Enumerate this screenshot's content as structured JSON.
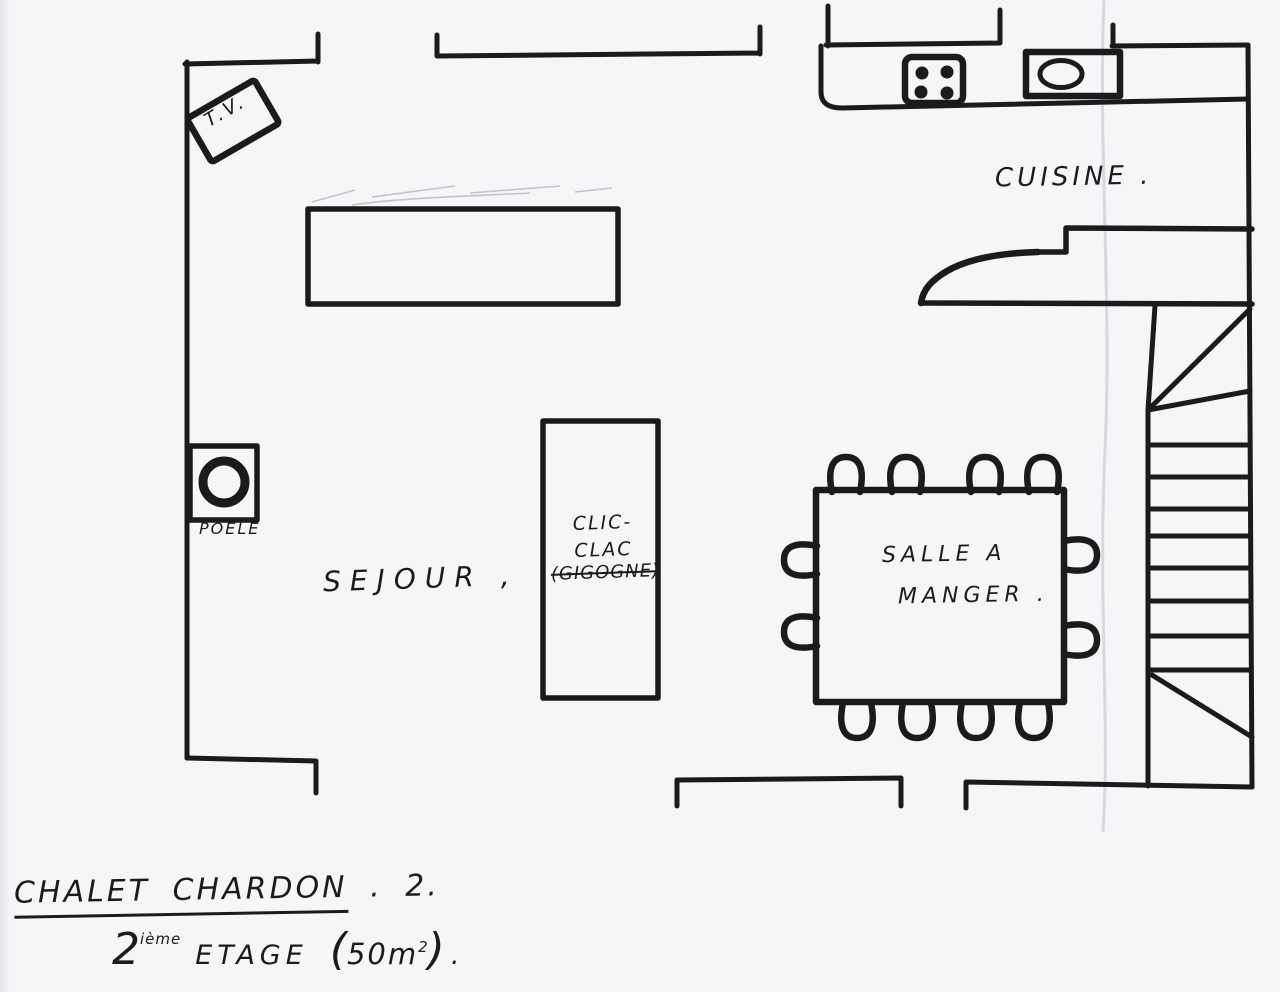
{
  "page": {
    "paper_color": "#f6f6f8",
    "ink_color": "#1b1b1b"
  },
  "plan": {
    "rooms": {
      "sejour": {
        "label": "SEJOUR ,"
      },
      "cuisine": {
        "label": "CUISINE ."
      },
      "salle_a_manger": {
        "label_line1": "SALLE A",
        "label_line2": "MANGER ."
      }
    },
    "furniture": {
      "tv": {
        "label": "T.V."
      },
      "poele": {
        "label": "POELE"
      },
      "clic_clac": {
        "line1": "CLIC-",
        "line2": "CLAC",
        "line3": "(GIGOGNE)"
      }
    },
    "icons": {
      "hob": "four-burner-hob-icon",
      "sink": "kitchen-sink-icon",
      "wood_stove": "wood-stove-icon",
      "tv": "tv-box-icon",
      "stairs": "staircase-icon",
      "chair": "dining-chair-icon"
    }
  },
  "title": {
    "line1_main": "CHALET CHARDON",
    "line1_suffix": ". 2.",
    "floor_number": "2",
    "floor_ordinal": "ième",
    "floor_word": "ETAGE",
    "area_open": "(",
    "area_value": "50m",
    "area_exponent": "2",
    "area_close": ")",
    "trailing_dot": "."
  }
}
